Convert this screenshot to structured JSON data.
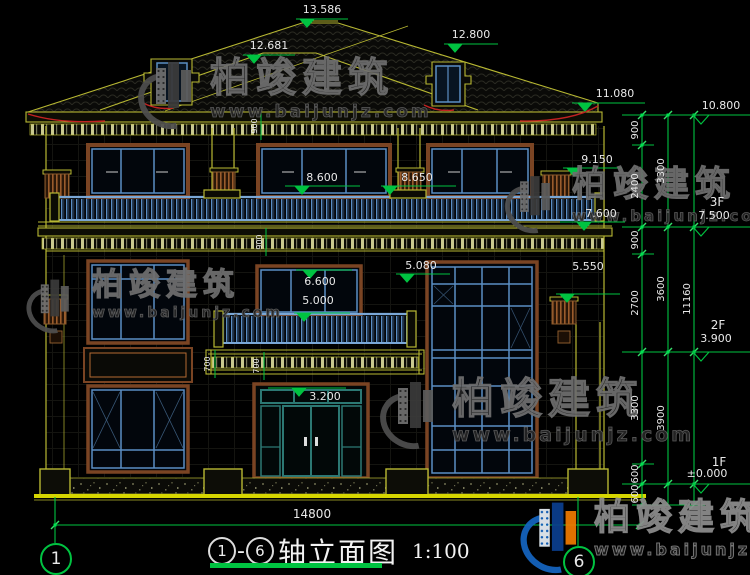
{
  "title": {
    "axis_start": "1",
    "dash": "-",
    "axis_end": "6",
    "text": "轴立面图",
    "scale": "1:100"
  },
  "axes": {
    "left_bubble": "1",
    "right_bubble": "6"
  },
  "dims": {
    "overall_width": "14800",
    "levels": [
      {
        "name": "main-ridge",
        "value": "13.586"
      },
      {
        "name": "secondary-ridge",
        "value": "12.681"
      },
      {
        "name": "dormer-ridge",
        "value": "12.800"
      },
      {
        "name": "eave",
        "value": "11.080"
      },
      {
        "name": "parapet-top",
        "value": "10.800"
      },
      {
        "name": "right-capital",
        "value": "9.150"
      },
      {
        "name": "balcony-3f-left",
        "value": "8.600"
      },
      {
        "name": "balcony-3f-right",
        "value": "8.650"
      },
      {
        "name": "cornice-3f",
        "value": "7.600"
      },
      {
        "name": "window-top-2f",
        "value": "6.600"
      },
      {
        "name": "balcony-2f",
        "value": "5.000"
      },
      {
        "name": "cornice-2f-left",
        "value": "5.080"
      },
      {
        "name": "cornice-2f-right",
        "value": "5.550"
      },
      {
        "name": "door-transom",
        "value": "3.200"
      }
    ],
    "floor_levels": [
      {
        "floor": "3F",
        "value": "7.500"
      },
      {
        "floor": "2F",
        "value": "3.900"
      },
      {
        "floor": "1F",
        "value": "±0.000"
      }
    ],
    "chain_inner": [
      "900",
      "2400",
      "900",
      "2700",
      "3300",
      "600",
      "600"
    ],
    "chain_middle": [
      "3300",
      "3600",
      "3900"
    ],
    "chain_total": "11160",
    "railing_height_dims": [
      "900",
      "900"
    ],
    "balcony_slab_dims": [
      "700",
      "700"
    ]
  },
  "watermark": {
    "brand": "柏竣建筑",
    "url": "www.baijunjz.com"
  },
  "colors": {
    "cad_yellow": "#b8b832",
    "cad_green": "#00c341",
    "dim_text": "#e9e9e9",
    "frame_brown": "#7a4423",
    "frame_blue": "#5b8ec4",
    "door_teal": "#2c7873",
    "accent_red": "#cc2222",
    "ground_yellow": "#d6d600",
    "logo_blue": "#1565c0",
    "logo_orange": "#ef7a00"
  }
}
